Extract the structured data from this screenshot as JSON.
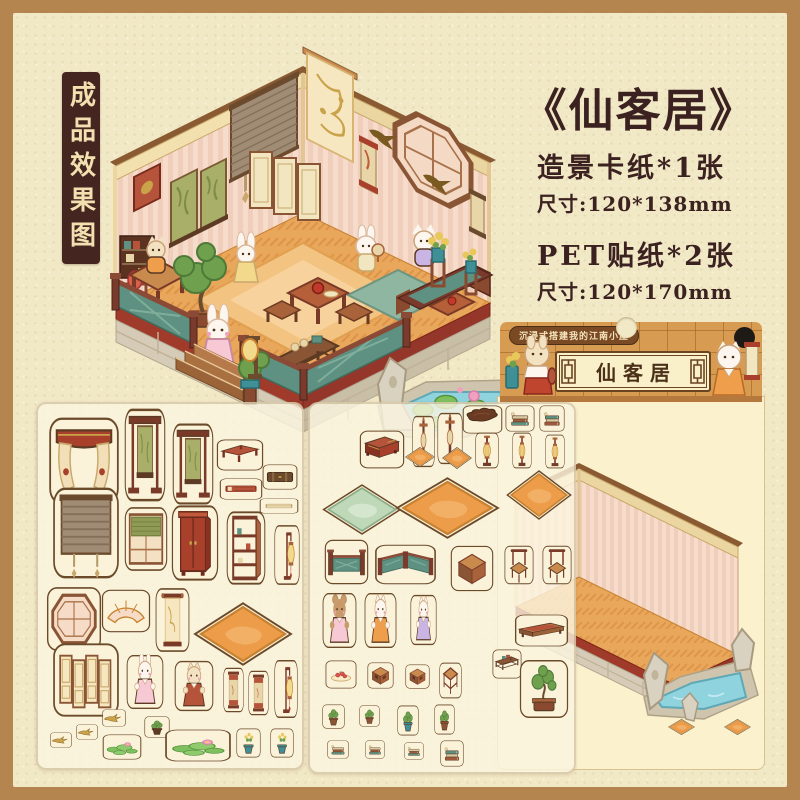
{
  "corner_badge": {
    "label": "成品效果图"
  },
  "title": {
    "label": "《仙客居》"
  },
  "specs": [
    {
      "name": "造景卡纸*1张",
      "size": "尺寸:120*138mm"
    },
    {
      "name": "PET贴纸*2张",
      "size": "尺寸:120*170mm"
    }
  ],
  "package": {
    "tagline": "沉浸式搭建我的江南小屋",
    "title": "仙客居",
    "left_character_icon": "rabbit-with-vase-icon",
    "right_character_icon": "cat-with-scroll-icon",
    "items": [
      {
        "name": "mat-small",
        "kind": "rug",
        "v": "orange",
        "x": 170,
        "y": 322,
        "w": 27,
        "h": 16
      },
      {
        "name": "mat-small",
        "kind": "rug",
        "v": "orange",
        "x": 226,
        "y": 322,
        "w": 27,
        "h": 16
      }
    ]
  },
  "colors": {
    "frame": "#B5854F",
    "panel": "#F1E8C6",
    "badge_bg": "#45251F",
    "badge_text": "#F2E0B0",
    "title_text": "#3B2220",
    "package_orange": "#D89B52",
    "label_cream": "#F9EFC9",
    "wall_pink": "#F7DCCB",
    "floor_orange": "#E9A75B",
    "railing_teal": "#5E9182",
    "floor_band_red": "#A03A2A",
    "pond_blue": "#8ED3DE"
  },
  "sheet1": {
    "items": [
      {
        "name": "curtain",
        "kind": "curtain",
        "x": 10,
        "y": 12,
        "w": 72,
        "h": 90
      },
      {
        "name": "scroll-stand",
        "kind": "scrollstand",
        "x": 86,
        "y": 3,
        "w": 42,
        "h": 96
      },
      {
        "name": "scroll-stand",
        "kind": "scrollstand",
        "x": 134,
        "y": 18,
        "w": 42,
        "h": 84
      },
      {
        "name": "side-table",
        "kind": "table",
        "v": "red",
        "x": 178,
        "y": 35,
        "w": 48,
        "h": 32
      },
      {
        "name": "suitcase",
        "kind": "case",
        "x": 224,
        "y": 60,
        "w": 36,
        "h": 26
      },
      {
        "name": "red-book",
        "kind": "book",
        "x": 181,
        "y": 74,
        "w": 44,
        "h": 22
      },
      {
        "name": "cream-box",
        "kind": "box",
        "x": 221,
        "y": 94,
        "w": 40,
        "h": 16
      },
      {
        "name": "bamboo-blind",
        "kind": "blind",
        "x": 14,
        "y": 82,
        "w": 68,
        "h": 94
      },
      {
        "name": "window-blind",
        "kind": "windowblind",
        "x": 86,
        "y": 102,
        "w": 44,
        "h": 66
      },
      {
        "name": "wardrobe",
        "kind": "wardrobe",
        "x": 133,
        "y": 100,
        "w": 48,
        "h": 78
      },
      {
        "name": "etagere-shelf",
        "kind": "etagere",
        "x": 188,
        "y": 106,
        "w": 40,
        "h": 76
      },
      {
        "name": "lantern-stand",
        "kind": "lantern",
        "v": "tall",
        "x": 236,
        "y": 120,
        "w": 26,
        "h": 62
      },
      {
        "name": "octagon-window",
        "kind": "octwindow",
        "x": 8,
        "y": 182,
        "w": 56,
        "h": 66
      },
      {
        "name": "fan-window",
        "kind": "fanwindow",
        "x": 63,
        "y": 185,
        "w": 50,
        "h": 44
      },
      {
        "name": "hanging-scroll",
        "kind": "scroll",
        "x": 117,
        "y": 183,
        "w": 35,
        "h": 66
      },
      {
        "name": "orange-rug",
        "kind": "rug",
        "v": "orange",
        "x": 155,
        "y": 198,
        "w": 100,
        "h": 64
      },
      {
        "name": "folding-screen",
        "kind": "screen",
        "x": 14,
        "y": 238,
        "w": 68,
        "h": 76
      },
      {
        "name": "rabbit-character",
        "kind": "character",
        "v": "bunny-pink",
        "x": 88,
        "y": 250,
        "w": 38,
        "h": 56
      },
      {
        "name": "cat-character",
        "kind": "character",
        "v": "cat-apron",
        "x": 136,
        "y": 256,
        "w": 40,
        "h": 52
      },
      {
        "name": "mini-scroll",
        "kind": "scroll",
        "v": "red",
        "x": 185,
        "y": 263,
        "w": 21,
        "h": 46
      },
      {
        "name": "mini-scroll",
        "kind": "scroll",
        "v": "red",
        "x": 210,
        "y": 266,
        "w": 21,
        "h": 46
      },
      {
        "name": "lantern-stand",
        "kind": "lantern",
        "v": "tall",
        "x": 236,
        "y": 255,
        "w": 24,
        "h": 60
      },
      {
        "name": "swallow",
        "kind": "bird",
        "x": 64,
        "y": 305,
        "w": 24,
        "h": 18
      },
      {
        "name": "swallow",
        "kind": "bird",
        "x": 38,
        "y": 320,
        "w": 22,
        "h": 16
      },
      {
        "name": "swallow",
        "kind": "bird",
        "x": 12,
        "y": 328,
        "w": 22,
        "h": 16
      },
      {
        "name": "plant-pot",
        "kind": "plant",
        "v": "dark",
        "x": 106,
        "y": 312,
        "w": 26,
        "h": 22
      },
      {
        "name": "lotus-leaves",
        "kind": "lotus",
        "x": 64,
        "y": 330,
        "w": 40,
        "h": 26
      },
      {
        "name": "lotus-leaves",
        "kind": "lotus",
        "x": 126,
        "y": 325,
        "w": 68,
        "h": 33
      },
      {
        "name": "potted-flowers",
        "kind": "plant",
        "v": "flower",
        "x": 198,
        "y": 324,
        "w": 25,
        "h": 30
      },
      {
        "name": "potted-flowers",
        "kind": "plant",
        "v": "flower",
        "x": 232,
        "y": 324,
        "w": 24,
        "h": 30
      }
    ]
  },
  "sheet2": {
    "items": [
      {
        "name": "red-chest",
        "kind": "chest",
        "x": 49,
        "y": 26,
        "w": 46,
        "h": 39
      },
      {
        "name": "lantern-stand",
        "kind": "lanternstand",
        "x": 102,
        "y": 11,
        "w": 23,
        "h": 53
      },
      {
        "name": "lantern-stand",
        "kind": "lanternstand",
        "x": 127,
        "y": 8,
        "w": 26,
        "h": 53
      },
      {
        "name": "ruyi-table",
        "kind": "ruyi",
        "x": 152,
        "y": 1,
        "w": 41,
        "h": 29
      },
      {
        "name": "book-stack",
        "kind": "books",
        "x": 195,
        "y": 1,
        "w": 30,
        "h": 27
      },
      {
        "name": "book-stack",
        "kind": "books",
        "v": "teal",
        "x": 229,
        "y": 1,
        "w": 26,
        "h": 27
      },
      {
        "name": "mat-small",
        "kind": "rug",
        "v": "orange",
        "x": 95,
        "y": 43,
        "w": 30,
        "h": 20
      },
      {
        "name": "mat-small",
        "kind": "rug",
        "v": "orange",
        "x": 132,
        "y": 43,
        "w": 30,
        "h": 22
      },
      {
        "name": "palace-lantern",
        "kind": "lantern",
        "v": "palace",
        "x": 165,
        "y": 28,
        "w": 24,
        "h": 37
      },
      {
        "name": "palace-lantern",
        "kind": "lantern",
        "v": "palace",
        "x": 202,
        "y": 28,
        "w": 20,
        "h": 37
      },
      {
        "name": "palace-lantern",
        "kind": "lantern",
        "v": "palace",
        "x": 235,
        "y": 30,
        "w": 20,
        "h": 35
      },
      {
        "name": "green-mat",
        "kind": "rug",
        "v": "green",
        "x": 12,
        "y": 80,
        "w": 80,
        "h": 51
      },
      {
        "name": "orange-rug-large",
        "kind": "rug",
        "v": "orange",
        "x": 85,
        "y": 73,
        "w": 105,
        "h": 62
      },
      {
        "name": "orange-rug-wide",
        "kind": "rug",
        "v": "orange",
        "x": 196,
        "y": 66,
        "w": 66,
        "h": 50
      },
      {
        "name": "railing",
        "kind": "railing",
        "x": 14,
        "y": 135,
        "w": 45,
        "h": 46
      },
      {
        "name": "railing-corner",
        "kind": "railing",
        "v": "corner",
        "x": 64,
        "y": 140,
        "w": 63,
        "h": 41
      },
      {
        "name": "square-stool",
        "kind": "stool",
        "x": 140,
        "y": 141,
        "w": 44,
        "h": 47
      },
      {
        "name": "chair",
        "kind": "chair",
        "x": 194,
        "y": 141,
        "w": 30,
        "h": 40
      },
      {
        "name": "chair",
        "kind": "chair",
        "x": 232,
        "y": 141,
        "w": 30,
        "h": 40
      },
      {
        "name": "bear-character",
        "kind": "character",
        "v": "bear-pink",
        "x": 12,
        "y": 188,
        "w": 35,
        "h": 57
      },
      {
        "name": "cat-character",
        "kind": "character",
        "v": "cat-orange",
        "x": 54,
        "y": 188,
        "w": 33,
        "h": 57
      },
      {
        "name": "cat-character",
        "kind": "character",
        "v": "cat-purple",
        "x": 100,
        "y": 190,
        "w": 27,
        "h": 52
      },
      {
        "name": "bench",
        "kind": "bench",
        "x": 204,
        "y": 210,
        "w": 55,
        "h": 33
      },
      {
        "name": "low-shelf",
        "kind": "shelf",
        "x": 182,
        "y": 245,
        "w": 30,
        "h": 30
      },
      {
        "name": "bonsai-tree",
        "kind": "bonsai",
        "x": 209,
        "y": 255,
        "w": 50,
        "h": 60
      },
      {
        "name": "food-plate",
        "kind": "food",
        "x": 15,
        "y": 256,
        "w": 32,
        "h": 29
      },
      {
        "name": "box-stool",
        "kind": "stool",
        "v": "box",
        "x": 57,
        "y": 258,
        "w": 27,
        "h": 27
      },
      {
        "name": "box-stool",
        "kind": "stool",
        "v": "box",
        "x": 95,
        "y": 260,
        "w": 25,
        "h": 25
      },
      {
        "name": "openwork-stool",
        "kind": "stool",
        "v": "open",
        "x": 129,
        "y": 258,
        "w": 23,
        "h": 37
      },
      {
        "name": "potted-plant",
        "kind": "plant",
        "x": 12,
        "y": 300,
        "w": 23,
        "h": 25
      },
      {
        "name": "potted-plant",
        "kind": "plant",
        "x": 49,
        "y": 301,
        "w": 21,
        "h": 22
      },
      {
        "name": "potted-plant",
        "kind": "plant",
        "v": "teal",
        "x": 87,
        "y": 301,
        "w": 22,
        "h": 31
      },
      {
        "name": "potted-plant",
        "kind": "plant",
        "x": 124,
        "y": 300,
        "w": 21,
        "h": 31
      },
      {
        "name": "book-stack",
        "kind": "books",
        "x": 17,
        "y": 336,
        "w": 22,
        "h": 19
      },
      {
        "name": "book-stack",
        "kind": "books",
        "x": 55,
        "y": 336,
        "w": 20,
        "h": 19
      },
      {
        "name": "book-stack",
        "kind": "books",
        "x": 94,
        "y": 338,
        "w": 20,
        "h": 18
      },
      {
        "name": "book-stack",
        "kind": "books",
        "v": "teal",
        "x": 130,
        "y": 336,
        "w": 24,
        "h": 27
      }
    ]
  }
}
